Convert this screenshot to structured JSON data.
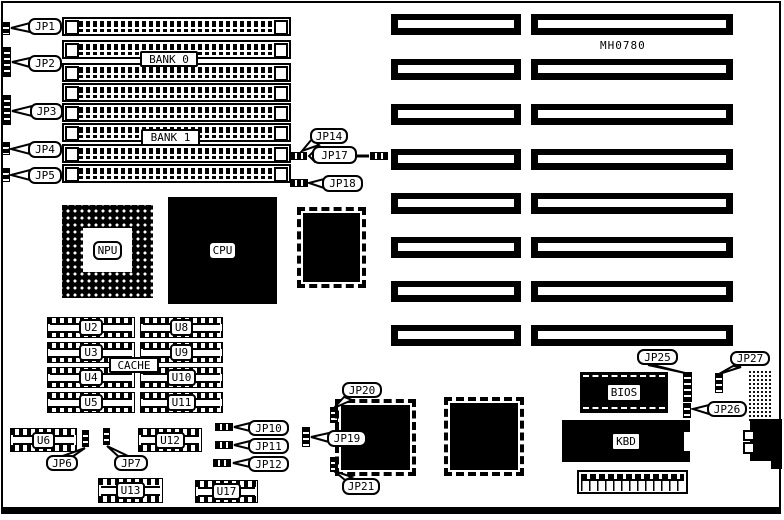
{
  "model_number": "MH0780",
  "memory": {
    "bank0": "BANK 0",
    "bank1": "BANK 1"
  },
  "chips": {
    "npu": "NPU",
    "cpu": "CPU",
    "cache": "CACHE",
    "bios": "BIOS",
    "kbd": "KBD"
  },
  "u_chips": {
    "u2": "U2",
    "u3": "U3",
    "u4": "U4",
    "u5": "U5",
    "u8": "U8",
    "u9": "U9",
    "u10": "U10",
    "u11": "U11",
    "u6": "U6",
    "u12": "U12",
    "u13": "U13",
    "u17": "U17"
  },
  "jumpers": {
    "jp1": "JP1",
    "jp2": "JP2",
    "jp3": "JP3",
    "jp4": "JP4",
    "jp5": "JP5",
    "jp6": "JP6",
    "jp7": "JP7",
    "jp10": "JP10",
    "jp11": "JP11",
    "jp12": "JP12",
    "jp14": "JP14",
    "jp17": "JP17",
    "jp18": "JP18",
    "jp19": "JP19",
    "jp20": "JP20",
    "jp21": "JP21",
    "jp25": "JP25",
    "jp26": "JP26",
    "jp27": "JP27"
  },
  "colors": {
    "ink": "#000000",
    "paper": "#ffffff"
  }
}
